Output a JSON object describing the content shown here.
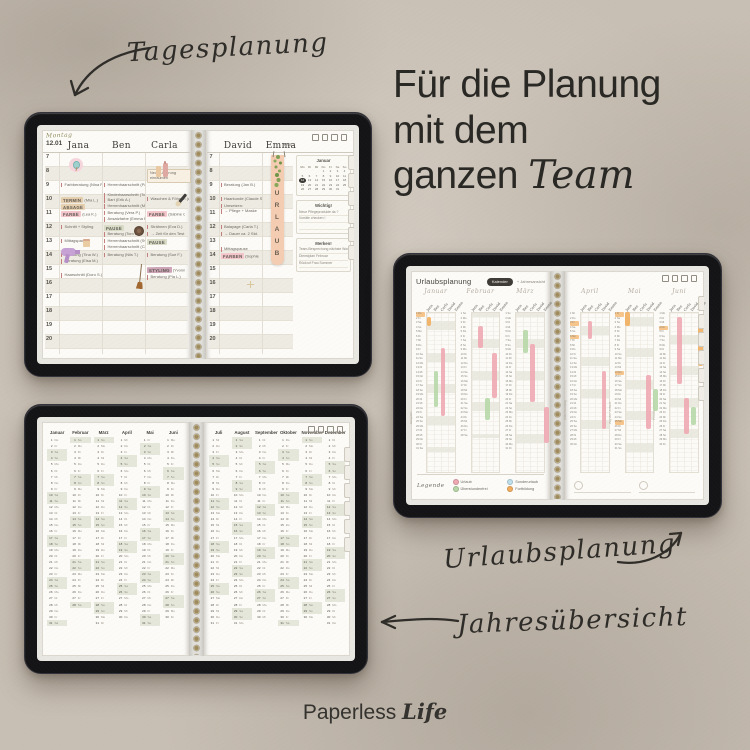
{
  "labels": {
    "tagesplanung": "Tagesplanung",
    "urlaubsplanung": "Urlaubsplanung",
    "jahresuebersicht": "Jahresübersicht"
  },
  "headline": {
    "line1": "Für die Planung",
    "line2": "mit dem",
    "line3_regular": "ganzen",
    "line3_italic": "Team"
  },
  "brand": {
    "regular": "Paperless",
    "italic": "Life"
  },
  "chip_colors": {
    "pink": "#f4c6cb",
    "tan": "#e6cfae",
    "sage": "#d9dcc6",
    "mauve": "#cda4b6"
  },
  "daily_planner": {
    "day_name": "Montag",
    "date": "12.01",
    "week": "KW 2",
    "hours": [
      "7",
      "8",
      "9",
      "10",
      "11",
      "12",
      "13",
      "14",
      "15",
      "16",
      "17",
      "18",
      "19",
      "20"
    ],
    "bookmark_letters": [
      "U",
      "R",
      "L",
      "A",
      "U",
      "B"
    ],
    "left_columns": [
      {
        "name": "Jana",
        "entries": [
          {
            "h": 9,
            "t": "Farbberatung (Nina P.)"
          },
          {
            "h": 10,
            "chip": "TERMIN",
            "c": "tan",
            "t": "(Mia L.)"
          },
          {
            "h": 10.55,
            "chip": "ABSAGE",
            "c": "tan"
          },
          {
            "h": 11,
            "chip": "FARBE",
            "c": "pink",
            "t": "(Lea K.)"
          },
          {
            "h": 12,
            "t": "Schnitt + Styling"
          },
          {
            "h": 13,
            "t": "Mittagspause"
          },
          {
            "h": 14,
            "t": "Beratung (Tina W.)"
          },
          {
            "h": 14.45,
            "t": "Beratung (Elsa M.)"
          },
          {
            "h": 15.45,
            "t": "Haarschnitt (Doro S.)"
          }
        ]
      },
      {
        "name": "Ben",
        "entries": [
          {
            "h": 9,
            "t": "Herrenhaarschnitt (Paul F.)"
          },
          {
            "h": 9.75,
            "t": "Kinderhaarschnitt (Tom T.)"
          },
          {
            "h": 10.1,
            "t": "Bart (Erik A.)"
          },
          {
            "h": 10.55,
            "t": "Herrenhaarschnitt (Max C.)"
          },
          {
            "h": 11,
            "t": "Beratung (Vera P.)"
          },
          {
            "h": 11.45,
            "t": "Ansatzfarbe (Emma R.)"
          },
          {
            "h": 12,
            "chip": "PAUSE",
            "c": "sage"
          },
          {
            "h": 12.55,
            "t": "Beratung (Tom B.)"
          },
          {
            "h": 13,
            "t": "Herrenhaarschnitt (Sven O.)"
          },
          {
            "h": 13.45,
            "t": "Herrenhaarschnitt (Carl N.)"
          },
          {
            "h": 14,
            "t": "Beratung (Nils T.)"
          }
        ]
      },
      {
        "name": "Carla",
        "entries": [
          {
            "h": 8,
            "t": "Neue Lieferung einräumen",
            "box": true
          },
          {
            "h": 10,
            "t": "Waschen & Föhnen (Anna B.)"
          },
          {
            "h": 11,
            "chip": "FARBE",
            "c": "pink",
            "t": "(Sabine C.)"
          },
          {
            "h": 12,
            "t": "Strähnen (Eva D.)"
          },
          {
            "h": 12.5,
            "t": "→ Zeit für den Test"
          },
          {
            "h": 13,
            "chip": "PAUSE",
            "c": "sage"
          },
          {
            "h": 14,
            "t": "Beratung (Sue F.)"
          },
          {
            "h": 15,
            "chip": "STYLING",
            "c": "mauve",
            "t": "(Yvonne S.)"
          },
          {
            "h": 15.6,
            "t": "Beratung (Pia L.)"
          }
        ]
      }
    ],
    "right_columns": [
      {
        "name": "David",
        "entries": [
          {
            "h": 9,
            "t": "Beratung (Jan B.)"
          },
          {
            "h": 10,
            "t": "Haarkunde (Claude S.)"
          },
          {
            "h": 10.5,
            "t": "Umsetzen:"
          },
          {
            "h": 10.9,
            "t": "→ Pflege + Maske"
          },
          {
            "h": 12,
            "t": "Balayage (Carla T.)"
          },
          {
            "h": 12.5,
            "t": "→ Dauer ca. 2 Std."
          },
          {
            "h": 13.6,
            "t": "Mittagspause"
          },
          {
            "h": 14,
            "chip": "FARBEN",
            "c": "pink",
            "t": "(Sophie T.)"
          }
        ]
      },
      {
        "name": "Emma",
        "entries": []
      }
    ],
    "mini_calendar": {
      "title": "Januar",
      "weekdays": [
        "Mo",
        "Di",
        "Mi",
        "Do",
        "Fr",
        "Sa",
        "So"
      ],
      "start": 3,
      "days": 31,
      "highlight": 12
    },
    "note_boxes": [
      {
        "title": "Wichtig!",
        "lines": [
          "Neue Pflegeprodukte da ?",
          "Vorräte checken !",
          ""
        ]
      },
      {
        "title": "Merken!",
        "lines": [
          "Team-Besprechung nächste Woche",
          "Dienstplan Februar",
          "Rückruf Frau Sommer"
        ]
      }
    ]
  },
  "vacation_planner": {
    "title": "Urlaubsplanung",
    "button": "Kalender",
    "button_secondary": "+ Jahresansicht",
    "legend_title": "Legende",
    "legend": [
      {
        "label": "Urlaub",
        "color": "#f0a9b2"
      },
      {
        "label": "Überstundenfrei",
        "color": "#b7d8a8"
      },
      {
        "label": "Sonderurlaub",
        "color": "#bfe0ec"
      },
      {
        "label": "Fortbildung",
        "color": "#f2ae5e"
      }
    ],
    "names": [
      "Jana",
      "Ben",
      "Carla",
      "David",
      "Emma"
    ],
    "months": [
      {
        "name": "Januar",
        "start": 3,
        "days": 31,
        "note": "Neujahr",
        "marks": [
          1
        ],
        "bars": [
          {
            "c": 0,
            "d1": 2,
            "d2": 3,
            "k": 3
          },
          {
            "c": 1,
            "d1": 14,
            "d2": 21,
            "k": 1
          },
          {
            "c": 2,
            "d1": 9,
            "d2": 23,
            "k": 0
          }
        ]
      },
      {
        "name": "Februar",
        "start": 6,
        "days": 28,
        "note": "",
        "marks": [],
        "bars": [
          {
            "c": 1,
            "d1": 4,
            "d2": 8,
            "k": 0
          },
          {
            "c": 2,
            "d1": 20,
            "d2": 24,
            "k": 1
          },
          {
            "c": 3,
            "d1": 10,
            "d2": 19,
            "k": 0
          }
        ]
      },
      {
        "name": "März",
        "start": 6,
        "days": 31,
        "note": "",
        "marks": [],
        "bars": [
          {
            "c": 1,
            "d1": 5,
            "d2": 9,
            "k": 1
          },
          {
            "c": 2,
            "d1": 8,
            "d2": 20,
            "k": 0
          },
          {
            "c": 4,
            "d1": 22,
            "d2": 29,
            "k": 0
          }
        ]
      },
      {
        "name": "April",
        "start": 2,
        "days": 30,
        "note": "Ostermontag",
        "marks": [
          3,
          6
        ],
        "bars": [
          {
            "c": 1,
            "d1": 3,
            "d2": 6,
            "k": 0
          },
          {
            "c": 3,
            "d1": 14,
            "d2": 26,
            "k": 0
          }
        ]
      },
      {
        "name": "Mai",
        "start": 4,
        "days": 31,
        "note": "Tag der Arbeit",
        "marks": [
          1,
          14,
          25
        ],
        "bars": [
          {
            "c": 0,
            "d1": 1,
            "d2": 3,
            "k": 3
          },
          {
            "c": 3,
            "d1": 15,
            "d2": 26,
            "k": 0
          },
          {
            "c": 4,
            "d1": 18,
            "d2": 22,
            "k": 1
          }
        ]
      },
      {
        "name": "Juni",
        "start": 0,
        "days": 30,
        "note": "Fronleichnam",
        "marks": [
          4
        ],
        "bars": [
          {
            "c": 1,
            "d1": 2,
            "d2": 16,
            "k": 0
          },
          {
            "c": 4,
            "d1": 2,
            "d2": 12,
            "k": 3
          },
          {
            "c": 2,
            "d1": 20,
            "d2": 27,
            "k": 0
          },
          {
            "c": 3,
            "d1": 22,
            "d2": 25,
            "k": 1
          }
        ]
      }
    ]
  },
  "year_overview": {
    "weekdays": [
      "Mo",
      "Di",
      "Mi",
      "Do",
      "Fr",
      "Sa",
      "So"
    ],
    "months": [
      {
        "name": "Januar",
        "start": 3,
        "days": 31
      },
      {
        "name": "Februar",
        "start": 6,
        "days": 28
      },
      {
        "name": "März",
        "start": 6,
        "days": 31
      },
      {
        "name": "April",
        "start": 2,
        "days": 30
      },
      {
        "name": "Mai",
        "start": 4,
        "days": 31
      },
      {
        "name": "Juni",
        "start": 0,
        "days": 30
      },
      {
        "name": "Juli",
        "start": 2,
        "days": 31
      },
      {
        "name": "August",
        "start": 5,
        "days": 31
      },
      {
        "name": "September",
        "start": 1,
        "days": 30
      },
      {
        "name": "Oktober",
        "start": 3,
        "days": 31
      },
      {
        "name": "November",
        "start": 6,
        "days": 30
      },
      {
        "name": "Dezember",
        "start": 1,
        "days": 31
      }
    ]
  }
}
